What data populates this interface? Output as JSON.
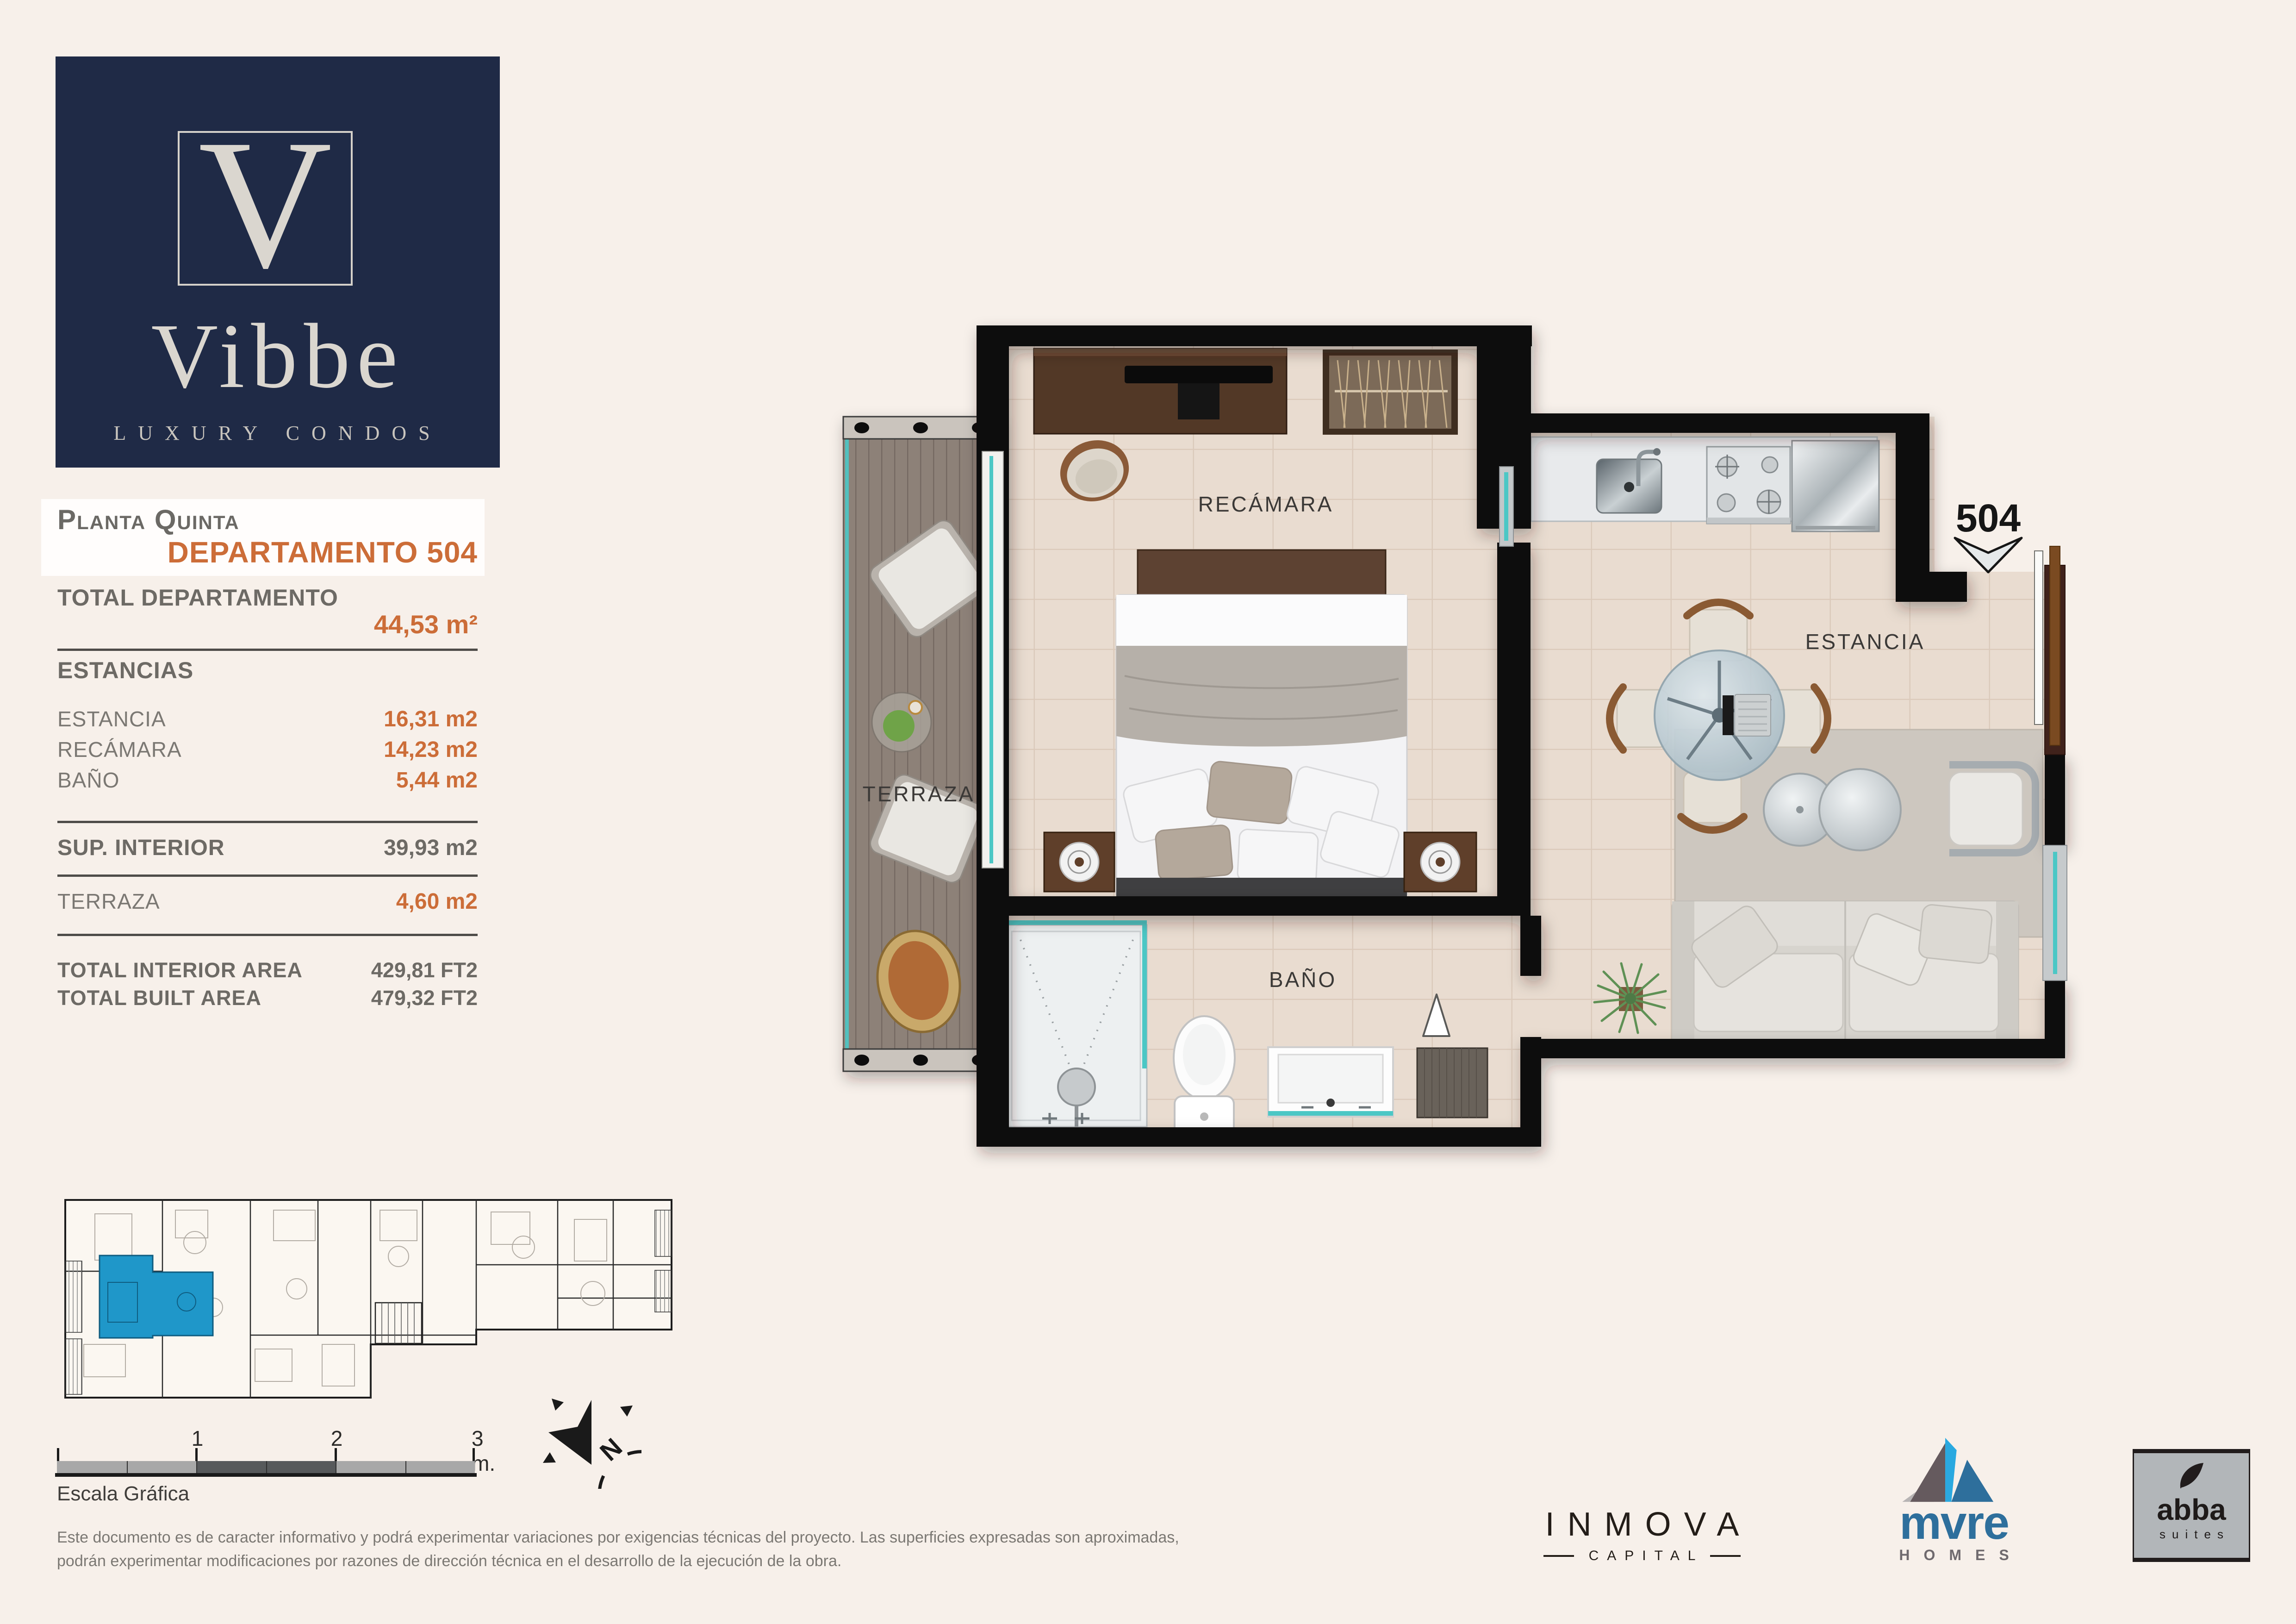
{
  "page": {
    "background": "#f7f0ea"
  },
  "brand": {
    "logo_letter": "V",
    "name": "Vibbe",
    "tagline": "LUXURY CONDOS",
    "navy": "#1f2a46",
    "cream_text": "#dad6cf"
  },
  "summary": {
    "floor_label": "Planta Quinta",
    "unit_label": "DEPARTAMENTO 504",
    "total_label": "TOTAL DEPARTAMENTO",
    "total_value": "44,53 m²",
    "sections_label": "ESTANCIAS",
    "rows": [
      {
        "label": "ESTANCIA",
        "value": "16,31 m2"
      },
      {
        "label": "RECÁMARA",
        "value": "14,23 m2"
      },
      {
        "label": "BAÑO",
        "value": "5,44 m2"
      }
    ],
    "interior_label": "SUP. INTERIOR",
    "interior_value": "39,93 m2",
    "terrace_label": "TERRAZA",
    "terrace_value": "4,60 m2",
    "totals": [
      {
        "label": "TOTAL INTERIOR AREA",
        "value": "429,81 FT2"
      },
      {
        "label": "TOTAL BUILT AREA",
        "value": "479,32 FT2"
      }
    ],
    "accent_color": "#cc6d38",
    "label_color": "#6d6a65"
  },
  "plan": {
    "unit_number": "504",
    "rooms": [
      {
        "label": "RECÁMARA"
      },
      {
        "label": "ESTANCIA"
      },
      {
        "label": "BAÑO"
      },
      {
        "label": "TERRAZA"
      }
    ],
    "wall_color": "#0e0e0e",
    "floor_color": "#e9dcd0",
    "glass_color": "#4cc7c5",
    "deck_color": "#8d8178"
  },
  "key_plan": {
    "highlight_color": "#1f97c9"
  },
  "scale_bar": {
    "ticks": [
      "1",
      "2",
      "3 m."
    ],
    "caption": "Escala Gráfica"
  },
  "compass": {
    "north_label": "N"
  },
  "disclaimer": {
    "line1": "Este documento es de caracter informativo y podrá experimentar variaciones por exigencias técnicas del proyecto. Las superficies expresadas son aproximadas,",
    "line2": "podrán experimentar modificaciones por razones de dirección técnica en el desarrollo de la ejecución de la obra."
  },
  "footer_logos": {
    "inmova": {
      "name": "INMOVA",
      "sub": "CAPITAL"
    },
    "mvre": {
      "name": "mvre",
      "sub": "HOMES",
      "blue": "#2e6f9c",
      "cyan": "#2aa9e0"
    },
    "abba": {
      "name": "abba",
      "sub": "suites"
    }
  }
}
